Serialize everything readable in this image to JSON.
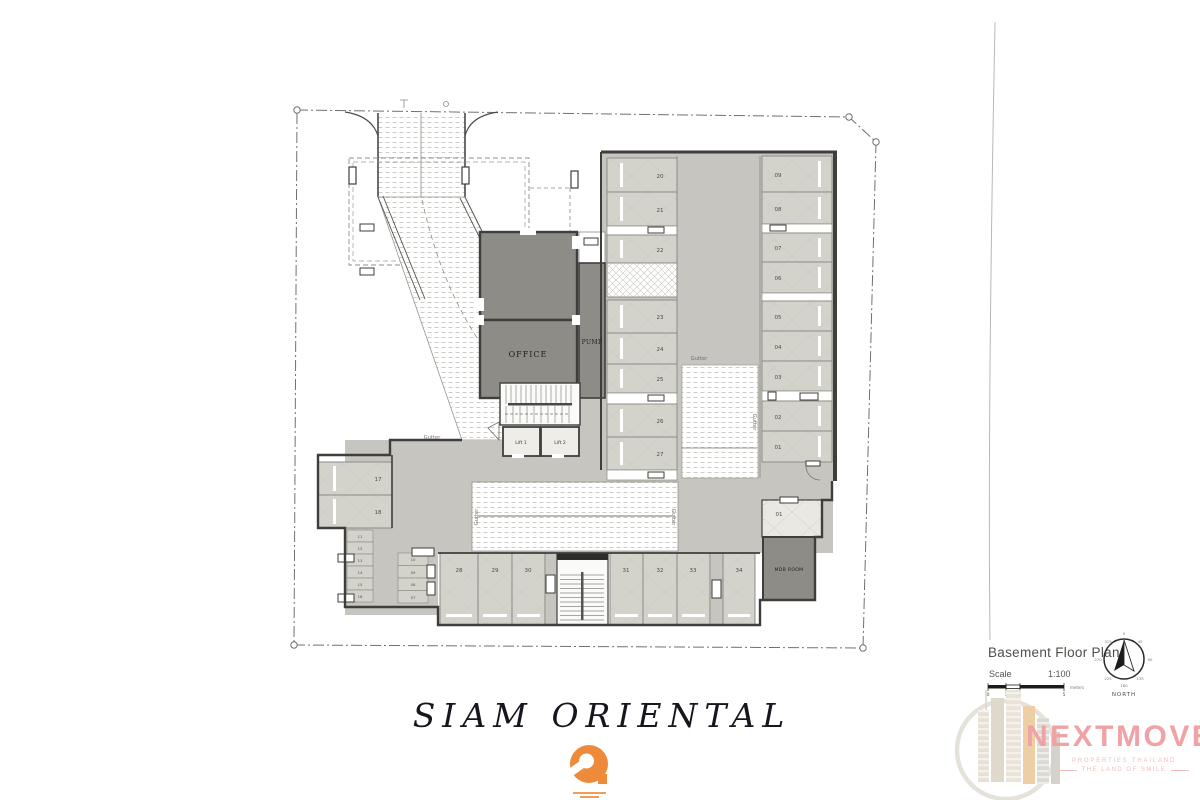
{
  "project": {
    "title": "SIAM ORIENTAL",
    "logo_color": "#ee8b3a"
  },
  "plan": {
    "labels": {
      "office": "OFFICE",
      "pump": "PUMP",
      "mdb_room": "MDB ROOM",
      "lift_1": "Lift 1",
      "lift_2": "Lift 2",
      "gutter": "Gutter"
    },
    "stalls": {
      "middle_upper": [
        "20",
        "21",
        "22"
      ],
      "middle_lower": [
        "23",
        "24",
        "25",
        "26",
        "27"
      ],
      "right_column": [
        "09",
        "08",
        "07",
        "06",
        "05",
        "04",
        "03",
        "02",
        "01"
      ],
      "left_pair": [
        "17",
        "18"
      ],
      "mini_left": [
        "11",
        "12",
        "13",
        "14",
        "15",
        "16"
      ],
      "mini_mid": [
        "10",
        "09",
        "08",
        "07"
      ],
      "bottom_row": [
        "28",
        "29",
        "30",
        "31",
        "32",
        "33",
        "34"
      ],
      "corner": [
        "01"
      ]
    },
    "colors": {
      "stall": "#d3d2cb",
      "aisle": "#c6c5bf",
      "room_dark": "#8e8c86",
      "wall": "#3f3e3b"
    }
  },
  "legend": {
    "title": "Basement Floor Plan",
    "scale_label": "Scale",
    "scale_value": "1:100",
    "scale_bar": {
      "ticks": [
        "0",
        "1",
        "2",
        "5"
      ],
      "unit": "meters"
    },
    "compass": {
      "degrees": [
        "0",
        "45",
        "90",
        "135",
        "180",
        "225",
        "270",
        "315"
      ],
      "north": "NORTH"
    }
  },
  "branding": {
    "wordmark": "NEXTMOVE",
    "tagline_line1": "PROPERTIES THAILAND",
    "tagline_line2": "THE LAND OF SMILE",
    "color": "#f0a2a4"
  }
}
